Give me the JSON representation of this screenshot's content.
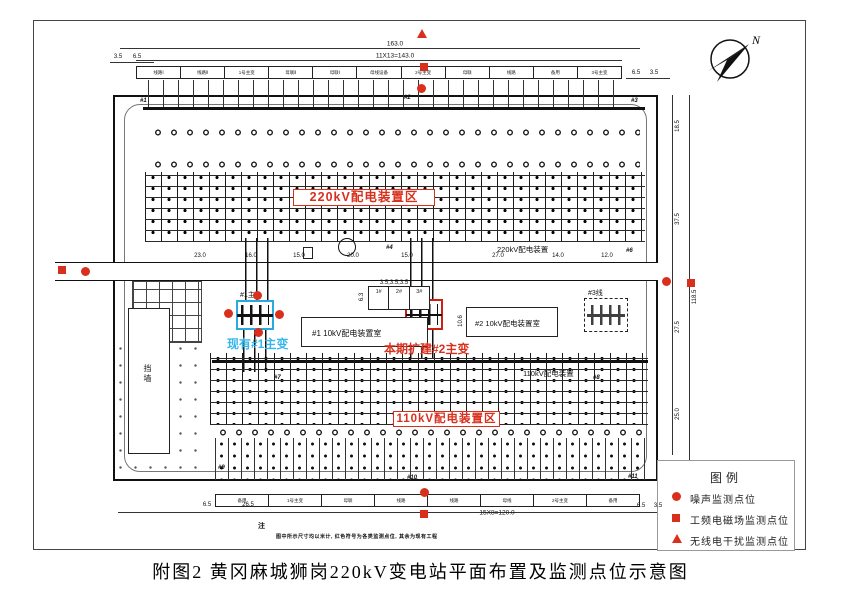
{
  "figure": {
    "caption": "附图2  黄冈麻城狮岗220kV变电站平面布置及监测点位示意图",
    "compass_label": "N",
    "note_title": "注",
    "note_text": "图中所示尺寸均以米计, 红色符号为各类监测点位, 其余为现有工程"
  },
  "areas": {
    "label_220_red": "220kV配电装置区",
    "label_110_red": "110kV配电装置区",
    "label_220_black": "220kV配电装置",
    "label_110_black": "110kV配电装置",
    "existing_transformer": "现有#1主变",
    "new_transformer": "本期扩建#2主变",
    "t1_tag": "#1主",
    "t2_tag": "#2主",
    "room1": "#1  10kV配电装置室",
    "room2": "#2  10kV配电装置室",
    "wall": "挡墙",
    "line3": "#3线"
  },
  "legend": {
    "title": "图例",
    "items": [
      {
        "symbol": "circle",
        "label": "噪声监测点位"
      },
      {
        "symbol": "square",
        "label": "工频电磁场监测点位"
      },
      {
        "symbol": "triangle",
        "label": "无线电干扰监测点位"
      }
    ]
  },
  "bays": {
    "top": [
      "线路Ⅰ",
      "线路Ⅱ",
      "1号主变",
      "母联Ⅱ",
      "母联Ⅰ",
      "母线设备",
      "2号主变",
      "母联",
      "线路",
      "备用",
      "3号主变"
    ],
    "bottom": [
      "备用",
      "1号主变",
      "母联",
      "线路",
      "线路",
      "母线",
      "2号主变",
      "备用"
    ],
    "cap_cells": [
      "1#",
      "2#",
      "3#"
    ]
  },
  "dim_labels": [
    {
      "t": "163.0",
      "x": 395,
      "y": 44,
      "r": 0,
      "big": true
    },
    {
      "t": "11X13=143.0",
      "x": 395,
      "y": 56,
      "r": 0,
      "big": true
    },
    {
      "t": "3.5",
      "x": 118,
      "y": 57,
      "r": 0
    },
    {
      "t": "6.5",
      "x": 137,
      "y": 57,
      "r": 0
    },
    {
      "t": "6.5",
      "x": 636,
      "y": 73,
      "r": 0
    },
    {
      "t": "3.5",
      "x": 654,
      "y": 73,
      "r": 0
    },
    {
      "t": "23.0",
      "x": 200,
      "y": 256,
      "r": 0
    },
    {
      "t": "16.0",
      "x": 251,
      "y": 256,
      "r": 0
    },
    {
      "t": "15.0",
      "x": 299,
      "y": 256,
      "r": 0
    },
    {
      "t": "20.0",
      "x": 353,
      "y": 256,
      "r": 0
    },
    {
      "t": "15.0",
      "x": 407,
      "y": 256,
      "r": 0
    },
    {
      "t": "27.0",
      "x": 498,
      "y": 256,
      "r": 0
    },
    {
      "t": "14.0",
      "x": 558,
      "y": 256,
      "r": 0
    },
    {
      "t": "12.0",
      "x": 607,
      "y": 256,
      "r": 0
    },
    {
      "t": "3.5,3.5,3.5",
      "x": 394,
      "y": 283,
      "r": 0
    },
    {
      "t": "6.3",
      "x": 362,
      "y": 297,
      "r": 90
    },
    {
      "t": "10.6",
      "x": 461,
      "y": 321,
      "r": 90
    },
    {
      "t": "6.5",
      "x": 207,
      "y": 505,
      "r": 0
    },
    {
      "t": "26.5",
      "x": 248,
      "y": 505,
      "r": 0
    },
    {
      "t": "15X8=120.0",
      "x": 497,
      "y": 513,
      "r": 0,
      "big": true
    },
    {
      "t": "6.5",
      "x": 641,
      "y": 506,
      "r": 0
    },
    {
      "t": "3.5",
      "x": 658,
      "y": 506,
      "r": 0
    },
    {
      "t": "18.5",
      "x": 678,
      "y": 126,
      "r": 90
    },
    {
      "t": "37.5",
      "x": 678,
      "y": 219,
      "r": 90
    },
    {
      "t": "27.5",
      "x": 678,
      "y": 327,
      "r": 90
    },
    {
      "t": "25.0",
      "x": 678,
      "y": 414,
      "r": 90
    },
    {
      "t": "118.5",
      "x": 695,
      "y": 297,
      "r": 90
    }
  ],
  "pole_labels": [
    {
      "t": "#1",
      "x": 140,
      "y": 98
    },
    {
      "t": "#2",
      "x": 404,
      "y": 95
    },
    {
      "t": "#3",
      "x": 631,
      "y": 98
    },
    {
      "t": "#4",
      "x": 386,
      "y": 245
    },
    {
      "t": "#6",
      "x": 626,
      "y": 248
    },
    {
      "t": "#7",
      "x": 274,
      "y": 375
    },
    {
      "t": "#8",
      "x": 593,
      "y": 375
    },
    {
      "t": "#9",
      "x": 218,
      "y": 465
    },
    {
      "t": "#10",
      "x": 407,
      "y": 475
    },
    {
      "t": "#11",
      "x": 628,
      "y": 474
    }
  ],
  "markers": {
    "circles": [
      [
        85,
        271
      ],
      [
        666,
        281
      ],
      [
        421,
        88
      ],
      [
        424,
        492
      ],
      [
        228,
        313
      ],
      [
        257,
        295
      ],
      [
        279,
        314
      ],
      [
        258,
        332
      ]
    ],
    "squares": [
      [
        62,
        270
      ],
      [
        691,
        283
      ],
      [
        424,
        67
      ],
      [
        424,
        514
      ]
    ],
    "triangles": [
      [
        422,
        34
      ]
    ]
  },
  "colors": {
    "marker_red": "#d9301e",
    "highlight_blue": "#28a9e0",
    "cyan_text": "#35b7ea",
    "highlight_red": "#cf2014"
  }
}
